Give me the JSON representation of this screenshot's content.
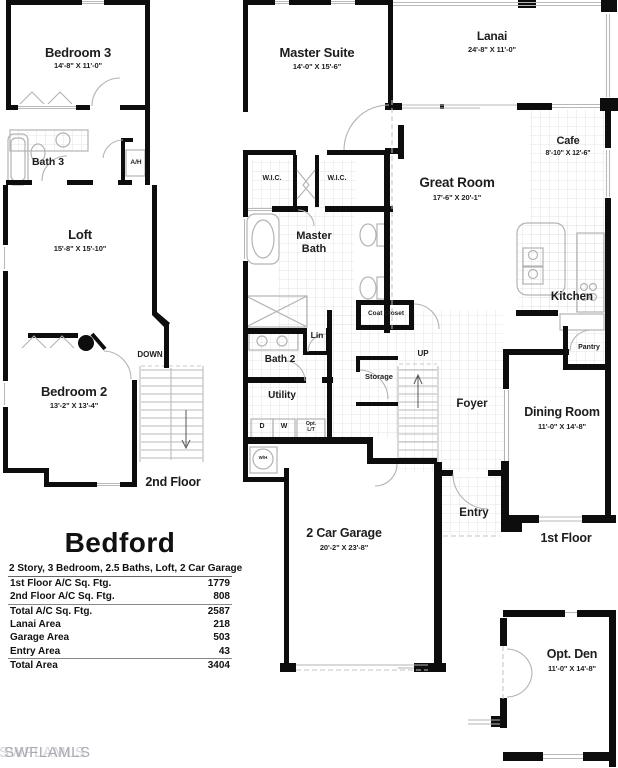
{
  "watermark": "SWFLAMLS",
  "plan": {
    "second_floor": {
      "floor_label": "2nd Floor",
      "rooms": {
        "bedroom3": {
          "name": "Bedroom 3",
          "dims": "14'-8\" X 11'-0\""
        },
        "loft": {
          "name": "Loft",
          "dims": "15'-8\" X 15'-10\""
        },
        "bedroom2": {
          "name": "Bedroom 2",
          "dims": "13'-2\" X 13'-4\""
        }
      },
      "labels": {
        "bath3": "Bath 3",
        "ah": "A/H",
        "down": "DOWN"
      }
    },
    "first_floor": {
      "floor_label": "1st Floor",
      "rooms": {
        "master_suite": {
          "name": "Master Suite",
          "dims": "14'-0\" X 15'-6\""
        },
        "lanai": {
          "name": "Lanai",
          "dims": "24'-8\" X 11'-0\""
        },
        "cafe": {
          "name": "Cafe",
          "dims": "8'-10\" X 12'-6\""
        },
        "great_room": {
          "name": "Great Room",
          "dims": "17'-6\" X 20'-1\""
        },
        "dining_room": {
          "name": "Dining Room",
          "dims": "11'-0\" X 14'-8\""
        },
        "garage": {
          "name": "2 Car Garage",
          "dims": "20'-2\" X 23'-8\""
        },
        "opt_den": {
          "name": "Opt. Den",
          "dims": "11'-0\" X 14'-8\""
        }
      },
      "labels": {
        "wic_left": "W.I.C.",
        "wic_right": "W.I.C.",
        "master_bath": "Master Bath",
        "kitchen": "Kitchen",
        "coat_closet": "Coat Closet",
        "lin": "Lin",
        "bath2": "Bath 2",
        "utility": "Utility",
        "dryer": "D",
        "washer": "W",
        "opt_lt": "Opt. L/T",
        "water_heater": "W/H",
        "storage": "Storage",
        "up": "UP",
        "foyer": "Foyer",
        "pantry": "Pantry",
        "entry": "Entry"
      }
    }
  },
  "spec_table": {
    "title": "Bedford",
    "subtitle": "2 Story, 3 Bedroom, 2.5 Baths, Loft, 2 Car Garage",
    "rows": [
      {
        "label": "1st Floor A/C Sq. Ftg.",
        "value": "1779"
      },
      {
        "label": "2nd Floor A/C Sq. Ftg.",
        "value": "808"
      },
      {
        "label": "Total A/C Sq.  Ftg.",
        "value": "2587"
      },
      {
        "label": "Lanai Area",
        "value": "218"
      },
      {
        "label": "Garage Area",
        "value": "503"
      },
      {
        "label": "Entry Area",
        "value": "43"
      },
      {
        "label": "Total Area",
        "value": "3404"
      }
    ]
  },
  "colors": {
    "wall": "#0d0d0d",
    "tile": "#dcdcdc",
    "fixture": "#b3b3b3",
    "watermark": "#a9a9b2"
  }
}
